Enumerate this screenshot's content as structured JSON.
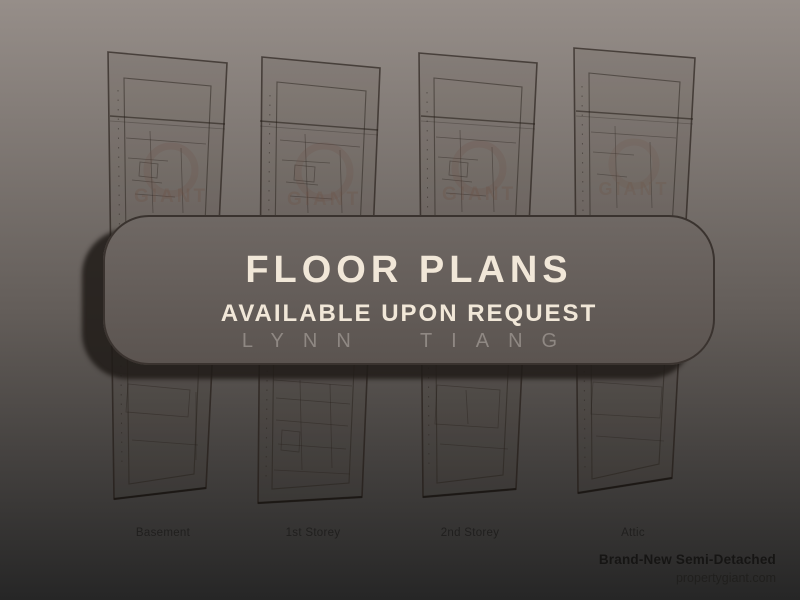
{
  "card": {
    "title": "FLOOR PLANS",
    "subtitle": "AVAILABLE UPON REQUEST",
    "agent_name": "LYNN TIANG"
  },
  "floor_plans": [
    {
      "label": "Basement"
    },
    {
      "label": "1st Storey"
    },
    {
      "label": "2nd Storey"
    },
    {
      "label": "Attic"
    }
  ],
  "footer": {
    "property_type": "Brand-New Semi-Detached",
    "website": "propertygiant.com"
  },
  "watermark": "GIANT",
  "colors": {
    "bg-top": "#968e89",
    "bg-mid": "#635d59",
    "bg-bottom": "#262626",
    "card-top": "#6f6864",
    "card-bottom": "#5b5450",
    "card-border": "#3a332f",
    "cream": "#f1e7d8",
    "muted": "#8f8883",
    "label": "#201f1e",
    "footer-bold": "#161514",
    "footer": "#201f1d"
  }
}
